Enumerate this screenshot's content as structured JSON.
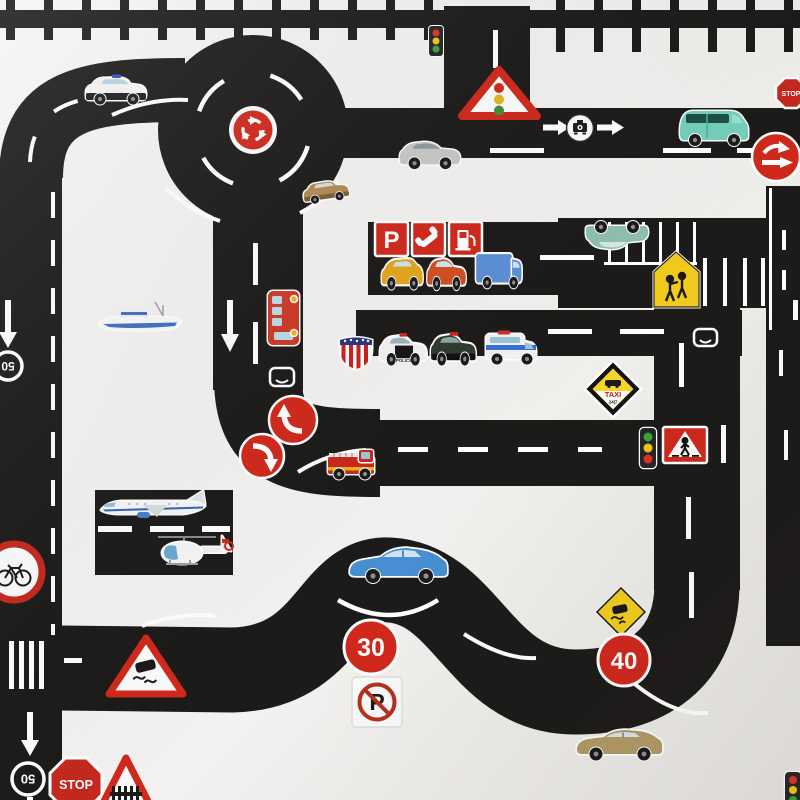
{
  "scene": {
    "description": "Overhead photo of a toy road play mat built from black road tape with white lane markings, decorated with vehicle stickers and traffic sign stickers on a white surface, with a railway track along the top edge",
    "colors": {
      "background": "#f4f2f0",
      "road": "#1d1b1a",
      "marking": "#ffffff",
      "sign_red": "#d0291c",
      "warning_yellow": "#f2cc1f",
      "taxi_yellow": "#f5d42a",
      "van_teal": "#74cfba",
      "coupe_blue": "#478fd2",
      "sedan_gold": "#b09a66",
      "bus_red": "#cf3a28"
    }
  },
  "signs": {
    "stop_top": {
      "label": "STOP"
    },
    "stop_bottom": {
      "label": "STOP"
    },
    "speed_limit_30": {
      "label": "30"
    },
    "speed_limit_40": {
      "label": "40"
    },
    "road_marking_50_upper": {
      "label": "50"
    },
    "road_marking_50_lower": {
      "label": "50"
    },
    "parking": {
      "label": "P"
    },
    "no_parking": {
      "label": "P"
    },
    "taxi": {
      "label": "TAXI",
      "sublabel": "24|7"
    }
  },
  "vehicles": {
    "police_wagon": {
      "label": "POLICE"
    },
    "police_sedan": {
      "label": "POLICE"
    }
  }
}
